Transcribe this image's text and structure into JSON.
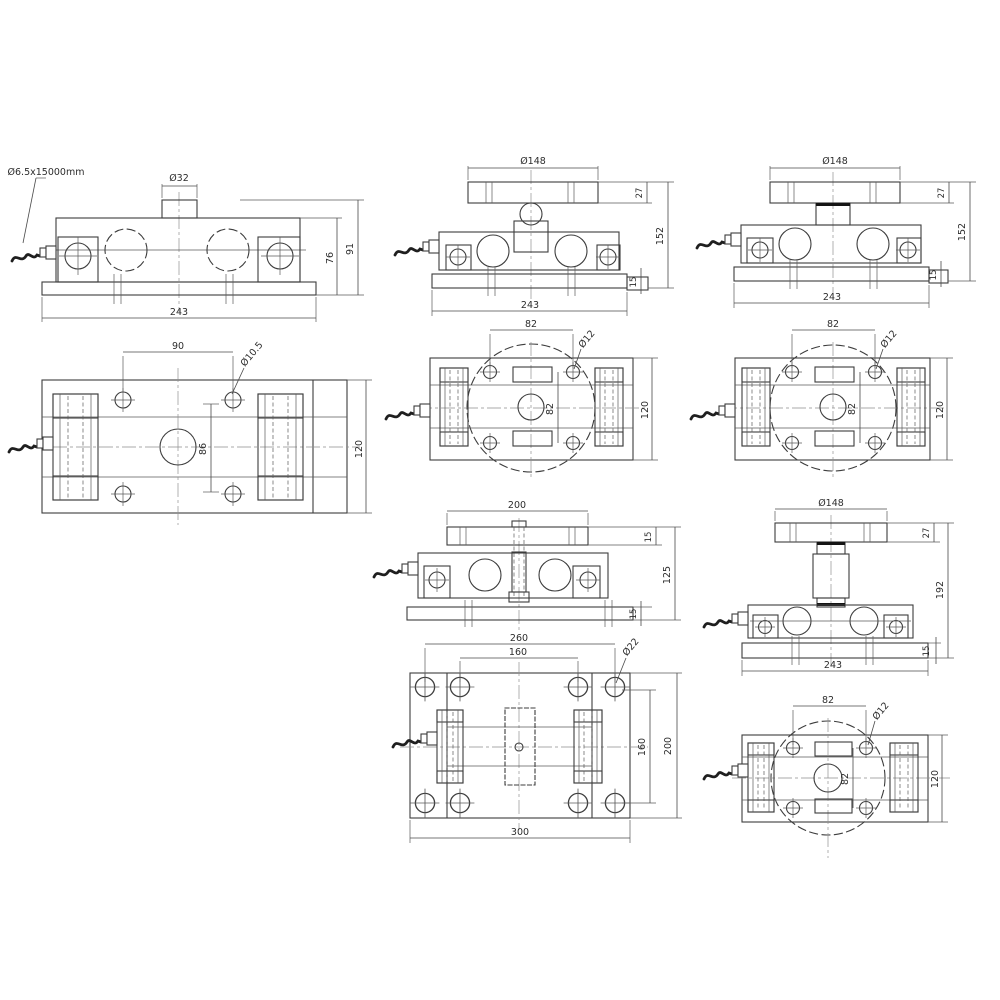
{
  "drawing": {
    "line_color": "#3d3d3d",
    "background": "#ffffff",
    "views": {
      "v1_side": {
        "cable_label": "Ø6.5x15000mm",
        "boss_dia": "Ø32",
        "width": "243",
        "cell_height": "76",
        "total_height": "91"
      },
      "v2_plan": {
        "hole_span": "90",
        "hole_dia": "Ø10.5",
        "center_span": "86",
        "depth": "120"
      },
      "v3_side": {
        "plate_dia": "Ø148",
        "plate_thickness": "27",
        "height": "152",
        "base_thickness": "15",
        "width": "243"
      },
      "v4_plan": {
        "hole_span": "82",
        "hole_dia": "Ø12",
        "hole_span_vertical": "82",
        "depth": "120"
      },
      "v5_side": {
        "plate_width": "200",
        "plate_thickness": "15",
        "height": "125",
        "base_thickness": "15"
      },
      "v6_plan": {
        "span_outer": "260",
        "span_inner": "160",
        "hole_dia": "Ø22",
        "span_vertical_inner": "160",
        "span_vertical_outer": "200",
        "width": "300"
      },
      "v7_side": {
        "plate_dia": "Ø148",
        "plate_thickness": "27",
        "height": "152",
        "base_thickness": "15",
        "width": "243"
      },
      "v8_plan": {
        "hole_span": "82",
        "hole_dia": "Ø12",
        "hole_span_vertical": "82",
        "depth": "120"
      },
      "v9_side": {
        "plate_dia": "Ø148",
        "plate_thickness": "27",
        "height": "192",
        "base_thickness": "15",
        "width": "243"
      },
      "v10_plan": {
        "hole_span": "82",
        "hole_dia": "Ø12",
        "hole_span_vertical": "82",
        "depth": "120"
      }
    }
  }
}
